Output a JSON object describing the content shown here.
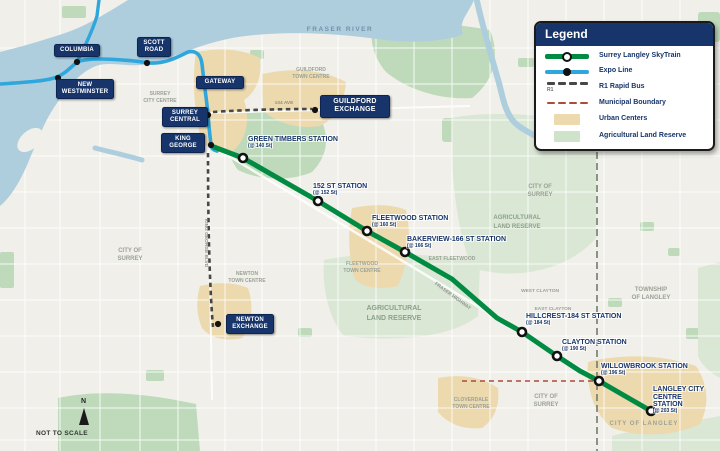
{
  "colors": {
    "navy": "#17356b",
    "skytrain_green": "#008a42",
    "expo_blue": "#2fa7dc",
    "urban_center": "#ecd9ae",
    "alr_green": "#d9e7d4",
    "park_green": "#bfdabb",
    "water_blue": "#aecede",
    "boundary_red": "#ad4a3c"
  },
  "legend": {
    "title": "Legend",
    "items": [
      {
        "label": "Surrey Langley SkyTrain"
      },
      {
        "label": "Expo Line"
      },
      {
        "label": "R1 Rapid Bus",
        "tag": "R1"
      },
      {
        "label": "Municipal Boundary"
      },
      {
        "label": "Urban Centers"
      },
      {
        "label": "Agricultural Land Reserve"
      }
    ]
  },
  "expo_stations": [
    {
      "label": "COLUMBIA"
    },
    {
      "label": "SCOTT ROAD"
    },
    {
      "label": "NEW WESTMINSTER"
    },
    {
      "label": "GATEWAY"
    },
    {
      "label": "SURREY CENTRAL"
    },
    {
      "label": "KING GEORGE"
    }
  ],
  "exchange_stations": [
    {
      "label": "GUILDFORD EXCHANGE"
    },
    {
      "label": "NEWTON EXCHANGE"
    }
  ],
  "skytrain_stations": [
    {
      "name": "GREEN TIMBERS STATION",
      "sub": "(@ 140 St)"
    },
    {
      "name": "152 ST STATION",
      "sub": "(@ 152 St)"
    },
    {
      "name": "FLEETWOOD STATION",
      "sub": "(@ 160 St)"
    },
    {
      "name": "BAKERVIEW-166 ST STATION",
      "sub": "(@ 166 St)"
    },
    {
      "name": "HILLCREST-184 ST STATION",
      "sub": "(@ 184 St)"
    },
    {
      "name": "CLAYTON STATION",
      "sub": "(@ 190 St)"
    },
    {
      "name": "WILLOWBROOK STATION",
      "sub": "(@ 196 St)"
    },
    {
      "name": "LANGLEY CITY CENTRE STATION",
      "sub": "(@ 203 St)"
    }
  ],
  "areas": {
    "fraser_river": "FRASER RIVER",
    "surrey_city_centre": [
      "SURREY",
      "CITY CENTRE"
    ],
    "guildford_town_centre": [
      "GUILDFORD",
      "TOWN CENTRE"
    ],
    "ave_104": "104 AVE",
    "city_of_surrey_w": [
      "CITY OF",
      "SURREY"
    ],
    "newton_town_centre": [
      "NEWTON",
      "TOWN CENTRE"
    ],
    "fleetwood_town_centre": [
      "FLEETWOOD",
      "TOWN CENTRE"
    ],
    "east_fleetwood": "EAST FLEETWOOD",
    "alr_centre": [
      "AGRICULTURAL",
      "LAND RESERVE"
    ],
    "alr_east": [
      "AGRICULTURAL",
      "LAND RESERVE"
    ],
    "city_of_surrey_ne": [
      "CITY OF",
      "SURREY"
    ],
    "township_of_langley": [
      "TOWNSHIP",
      "OF LANGLEY"
    ],
    "west_clayton": "WEST CLAYTON",
    "east_clayton": "EAST CLAYTON",
    "cloverdale_town_centre": [
      "CLOVERDALE",
      "TOWN CENTRE"
    ],
    "city_of_surrey_s": [
      "CITY OF",
      "SURREY"
    ],
    "city_of_langley": "CITY OF LANGLEY",
    "king_george_blvd": "KING GEORGE BLVD",
    "fraser_highway": "FRASER HIGHWAY"
  },
  "compass": {
    "north": "N",
    "scale_note": "NOT TO SCALE"
  }
}
